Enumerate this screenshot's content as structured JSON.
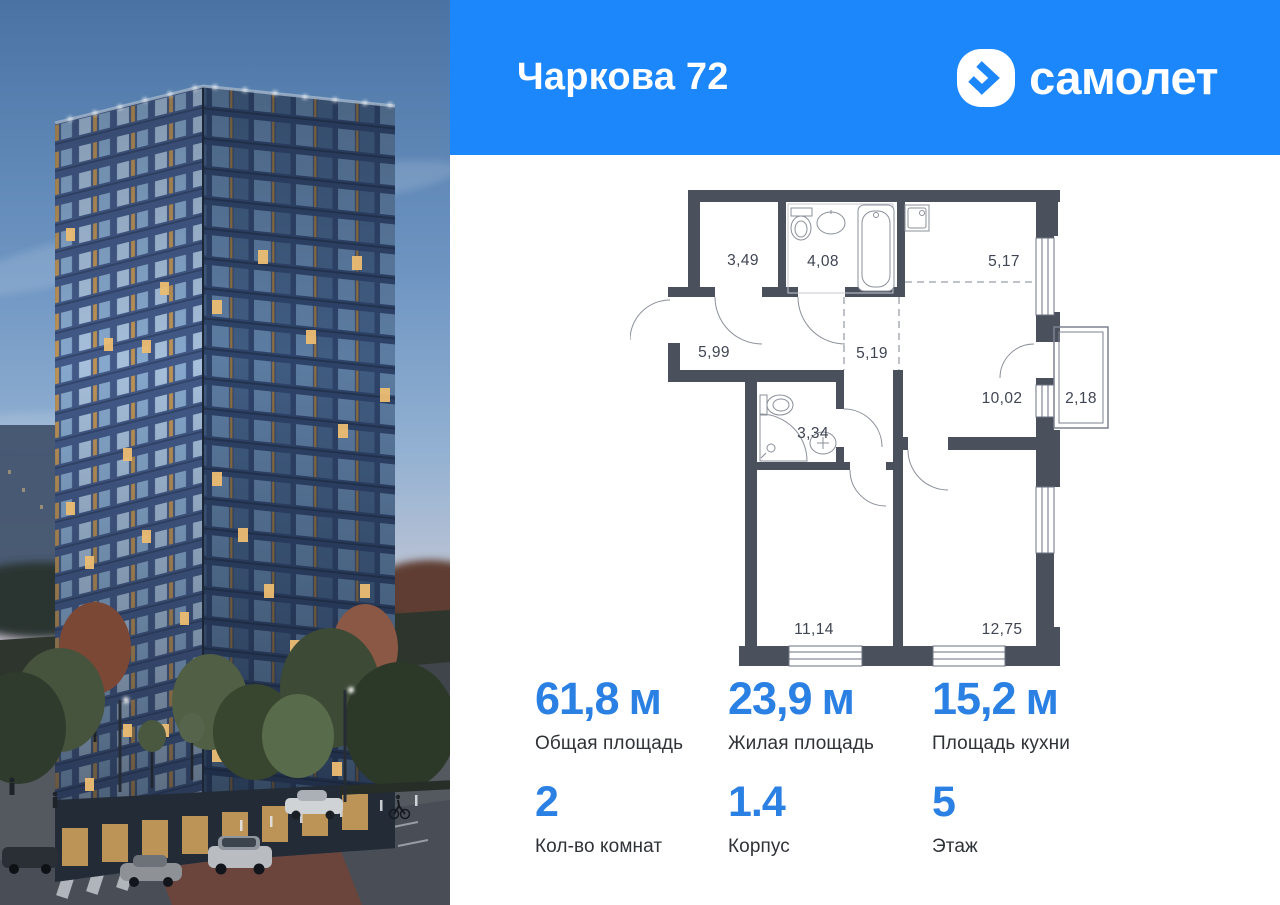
{
  "header": {
    "title": "Чаркова 72",
    "brand": "самолет",
    "background_color": "#1c87fa"
  },
  "floorplan": {
    "wall_color": "#4b505d",
    "rooms": [
      {
        "id": "closet",
        "area": "3,49"
      },
      {
        "id": "bathroom",
        "area": "4,08"
      },
      {
        "id": "kitchen",
        "area": "5,17"
      },
      {
        "id": "hallway",
        "area": "5,99"
      },
      {
        "id": "corridor",
        "area": "5,19"
      },
      {
        "id": "living",
        "area": "10,02"
      },
      {
        "id": "balcony",
        "area": "2,18"
      },
      {
        "id": "wc",
        "area": "3,34"
      },
      {
        "id": "bedroom-1",
        "area": "11,14"
      },
      {
        "id": "bedroom-2",
        "area": "12,75"
      }
    ]
  },
  "stats": {
    "row1": [
      {
        "value": "61,8",
        "unit": "м",
        "label": "Общая площадь"
      },
      {
        "value": "23,9",
        "unit": "м",
        "label": "Жилая площадь"
      },
      {
        "value": "15,2",
        "unit": "м",
        "label": "Площадь кухни"
      }
    ],
    "row2": [
      {
        "value": "2",
        "unit": "",
        "label": "Кол-во комнат"
      },
      {
        "value": "1.4",
        "unit": "",
        "label": "Корпус"
      },
      {
        "value": "5",
        "unit": "",
        "label": "Этаж"
      }
    ]
  },
  "accent_blue": "#2b80e4"
}
